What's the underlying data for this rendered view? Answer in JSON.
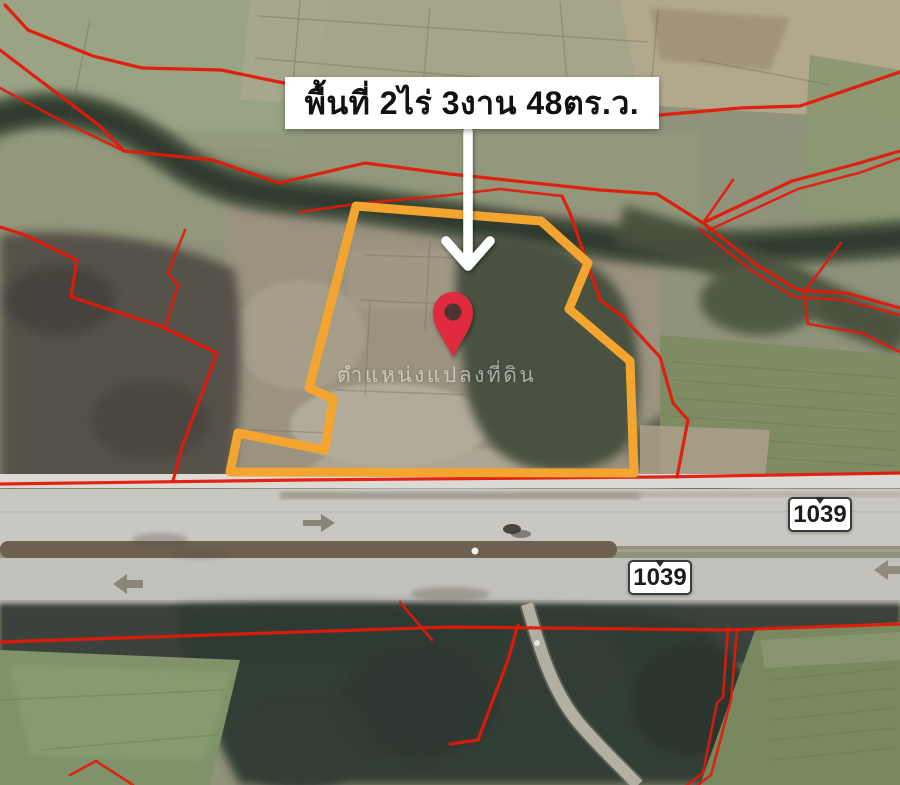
{
  "map": {
    "annotation": {
      "area_label": "พื้นที่ 2ไร่ 3งาน 48ตร.ว.",
      "watermark": "ตำแหน่งแปลงที่ดิน"
    },
    "route_shields": [
      {
        "label": "1039"
      },
      {
        "label": "1039"
      }
    ],
    "colors": {
      "plot_outline": "#F3A52F",
      "parcel_boundary": "#E2190B",
      "location_pin": "#E02B3C",
      "annotation_bg": "#FFFFFF",
      "annotation_text": "#111111",
      "shield_border": "#3B3B3B",
      "shield_text": "#1C1C1C"
    }
  }
}
